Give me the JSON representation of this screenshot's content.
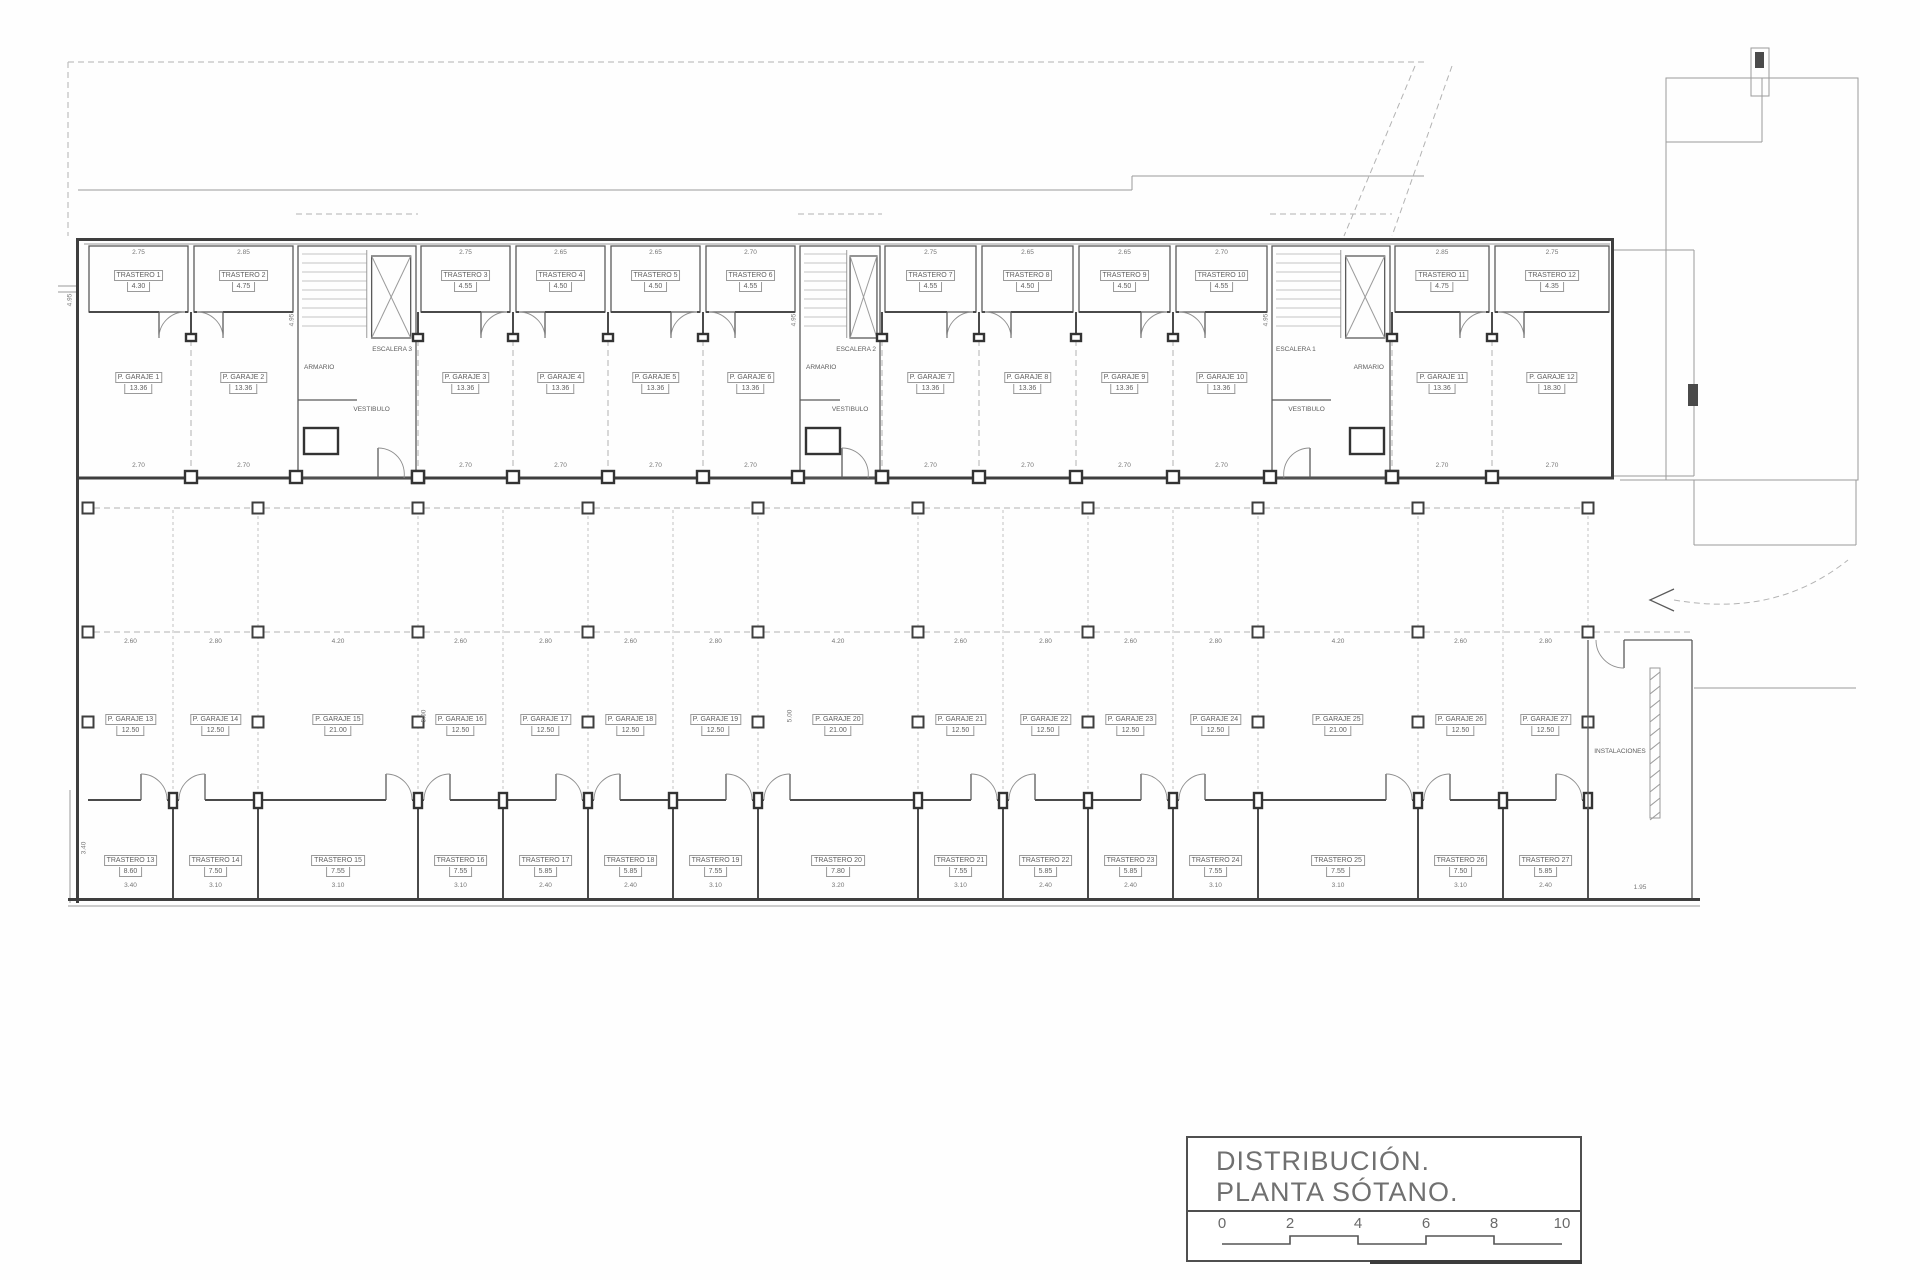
{
  "title_block": {
    "line1": "DISTRIBUCIÓN.",
    "line2": "PLANTA SÓTANO.",
    "scale_ticks": [
      "0",
      "2",
      "4",
      "6",
      "8",
      "10"
    ]
  },
  "colors": {
    "wall": "#3e3e3e",
    "thin": "#9b9b9b",
    "text": "#5f5f5f"
  },
  "plan": {
    "upper_bays": [
      {
        "kind": "g",
        "x": 86,
        "w": 105,
        "door": "r",
        "dim_top": "2.75",
        "dim_door": "2.70",
        "t": [
          "TRASTERO 1",
          "4.30"
        ],
        "g": [
          "P. GARAJE 1",
          "13.36"
        ]
      },
      {
        "kind": "g",
        "x": 191,
        "w": 105,
        "door": "l",
        "dim_top": "2.85",
        "dim_door": "2.70",
        "t": [
          "TRASTERO 2",
          "4.75"
        ],
        "g": [
          "P. GARAJE 2",
          "13.36"
        ]
      },
      {
        "kind": "s",
        "x": 296,
        "w": 122,
        "label": "ESCALERA 3",
        "armario": "ARMARIO",
        "vestibulo": "VESTIBULO",
        "arm": "l"
      },
      {
        "kind": "g",
        "x": 418,
        "w": 95,
        "door": "r",
        "dim_top": "2.75",
        "dim_door": "2.70",
        "t": [
          "TRASTERO 3",
          "4.55"
        ],
        "g": [
          "P. GARAJE 3",
          "13.36"
        ]
      },
      {
        "kind": "g",
        "x": 513,
        "w": 95,
        "door": "l",
        "dim_top": "2.65",
        "dim_door": "2.70",
        "t": [
          "TRASTERO 4",
          "4.50"
        ],
        "g": [
          "P. GARAJE 4",
          "13.36"
        ]
      },
      {
        "kind": "g",
        "x": 608,
        "w": 95,
        "door": "r",
        "dim_top": "2.65",
        "dim_door": "2.70",
        "t": [
          "TRASTERO 5",
          "4.50"
        ],
        "g": [
          "P. GARAJE 5",
          "13.36"
        ]
      },
      {
        "kind": "g",
        "x": 703,
        "w": 95,
        "door": "l",
        "dim_top": "2.70",
        "dim_door": "2.70",
        "t": [
          "TRASTERO 6",
          "4.55"
        ],
        "g": [
          "P. GARAJE 6",
          "13.36"
        ]
      },
      {
        "kind": "s",
        "x": 798,
        "w": 84,
        "label": "ESCALERA 2",
        "armario": "ARMARIO",
        "vestibulo": "VESTIBULO",
        "arm": "l"
      },
      {
        "kind": "g",
        "x": 882,
        "w": 97,
        "door": "r",
        "dim_top": "2.75",
        "dim_door": "2.70",
        "t": [
          "TRASTERO 7",
          "4.55"
        ],
        "g": [
          "P. GARAJE 7",
          "13.36"
        ]
      },
      {
        "kind": "g",
        "x": 979,
        "w": 97,
        "door": "l",
        "dim_top": "2.65",
        "dim_door": "2.70",
        "t": [
          "TRASTERO 8",
          "4.50"
        ],
        "g": [
          "P. GARAJE 8",
          "13.36"
        ]
      },
      {
        "kind": "g",
        "x": 1076,
        "w": 97,
        "door": "r",
        "dim_top": "2.65",
        "dim_door": "2.70",
        "t": [
          "TRASTERO 9",
          "4.50"
        ],
        "g": [
          "P. GARAJE 9",
          "13.36"
        ]
      },
      {
        "kind": "g",
        "x": 1173,
        "w": 97,
        "door": "l",
        "dim_top": "2.70",
        "dim_door": "2.70",
        "t": [
          "TRASTERO 10",
          "4.55"
        ],
        "g": [
          "P. GARAJE 10",
          "13.36"
        ]
      },
      {
        "kind": "s",
        "x": 1270,
        "w": 122,
        "label": "ESCALERA 1",
        "armario": "ARMARIO",
        "vestibulo": "VESTIBULO",
        "arm": "r"
      },
      {
        "kind": "g",
        "x": 1392,
        "w": 100,
        "door": "r",
        "dim_top": "2.85",
        "dim_door": "2.70",
        "t": [
          "TRASTERO 11",
          "4.75"
        ],
        "g": [
          "P. GARAJE 11",
          "13.36"
        ]
      },
      {
        "kind": "g",
        "x": 1492,
        "w": 120,
        "door": "l",
        "dim_top": "2.75",
        "dim_door": "2.70",
        "t": [
          "TRASTERO 12",
          "4.35"
        ],
        "g": [
          "P. GARAJE 12",
          "18.30"
        ]
      }
    ],
    "lower_stalls": [
      {
        "x": 88,
        "w": 85,
        "dim": "2.60",
        "dim_bottom": "3.40",
        "g": [
          "P. GARAJE 13",
          "12.50"
        ],
        "t": [
          "TRASTERO 13",
          "8.60"
        ]
      },
      {
        "x": 173,
        "w": 85,
        "dim": "2.80",
        "dim_bottom": "3.10",
        "g": [
          "P. GARAJE 14",
          "12.50"
        ],
        "t": [
          "TRASTERO 14",
          "7.50"
        ]
      },
      {
        "x": 258,
        "w": 160,
        "dim": "4.20",
        "dim_bottom": "3.10",
        "g": [
          "P. GARAJE 15",
          "21.00"
        ],
        "t": [
          "TRASTERO 15",
          "7.55"
        ]
      },
      {
        "x": 418,
        "w": 85,
        "dim": "2.60",
        "dim_bottom": "3.10",
        "g": [
          "P. GARAJE 16",
          "12.50"
        ],
        "t": [
          "TRASTERO 16",
          "7.55"
        ]
      },
      {
        "x": 503,
        "w": 85,
        "dim": "2.80",
        "dim_bottom": "2.40",
        "g": [
          "P. GARAJE 17",
          "12.50"
        ],
        "t": [
          "TRASTERO 17",
          "5.85"
        ]
      },
      {
        "x": 588,
        "w": 85,
        "dim": "2.60",
        "dim_bottom": "2.40",
        "g": [
          "P. GARAJE 18",
          "12.50"
        ],
        "t": [
          "TRASTERO 18",
          "5.85"
        ]
      },
      {
        "x": 673,
        "w": 85,
        "dim": "2.80",
        "dim_bottom": "3.10",
        "g": [
          "P. GARAJE 19",
          "12.50"
        ],
        "t": [
          "TRASTERO 19",
          "7.55"
        ]
      },
      {
        "x": 758,
        "w": 160,
        "dim": "4.20",
        "dim_bottom": "3.20",
        "g": [
          "P. GARAJE 20",
          "21.00"
        ],
        "t": [
          "TRASTERO 20",
          "7.80"
        ]
      },
      {
        "x": 918,
        "w": 85,
        "dim": "2.60",
        "dim_bottom": "3.10",
        "g": [
          "P. GARAJE 21",
          "12.50"
        ],
        "t": [
          "TRASTERO 21",
          "7.55"
        ]
      },
      {
        "x": 1003,
        "w": 85,
        "dim": "2.80",
        "dim_bottom": "2.40",
        "g": [
          "P. GARAJE 22",
          "12.50"
        ],
        "t": [
          "TRASTERO 22",
          "5.85"
        ]
      },
      {
        "x": 1088,
        "w": 85,
        "dim": "2.60",
        "dim_bottom": "2.40",
        "g": [
          "P. GARAJE 23",
          "12.50"
        ],
        "t": [
          "TRASTERO 23",
          "5.85"
        ]
      },
      {
        "x": 1173,
        "w": 85,
        "dim": "2.80",
        "dim_bottom": "3.10",
        "g": [
          "P. GARAJE 24",
          "12.50"
        ],
        "t": [
          "TRASTERO 24",
          "7.55"
        ]
      },
      {
        "x": 1258,
        "w": 160,
        "dim": "4.20",
        "dim_bottom": "3.10",
        "g": [
          "P. GARAJE 25",
          "21.00"
        ],
        "t": [
          "TRASTERO 25",
          "7.55"
        ]
      },
      {
        "x": 1418,
        "w": 85,
        "dim": "2.60",
        "dim_bottom": "3.10",
        "g": [
          "P. GARAJE 26",
          "12.50"
        ],
        "t": [
          "TRASTERO 26",
          "7.50"
        ]
      },
      {
        "x": 1503,
        "w": 85,
        "dim": "2.80",
        "dim_bottom": "2.40",
        "g": [
          "P. GARAJE 27",
          "12.50"
        ],
        "t": [
          "TRASTERO 27",
          "5.85"
        ]
      }
    ],
    "instalaciones": {
      "label": "INSTALACIONES"
    },
    "misc_dims": [
      {
        "t": "4.95",
        "x": 292,
        "y": 320,
        "v": 1
      },
      {
        "t": "4.95",
        "x": 794,
        "y": 320,
        "v": 1
      },
      {
        "t": "4.95",
        "x": 1266,
        "y": 320,
        "v": 1
      },
      {
        "t": "4.95",
        "x": 70,
        "y": 300,
        "v": 1
      },
      {
        "t": "5.00",
        "x": 424,
        "y": 716,
        "v": 1
      },
      {
        "t": "5.00",
        "x": 790,
        "y": 716,
        "v": 1
      },
      {
        "t": "3.40",
        "x": 84,
        "y": 848,
        "v": 1
      },
      {
        "t": "1.95",
        "x": 1640,
        "y": 884,
        "v": 0
      }
    ]
  }
}
